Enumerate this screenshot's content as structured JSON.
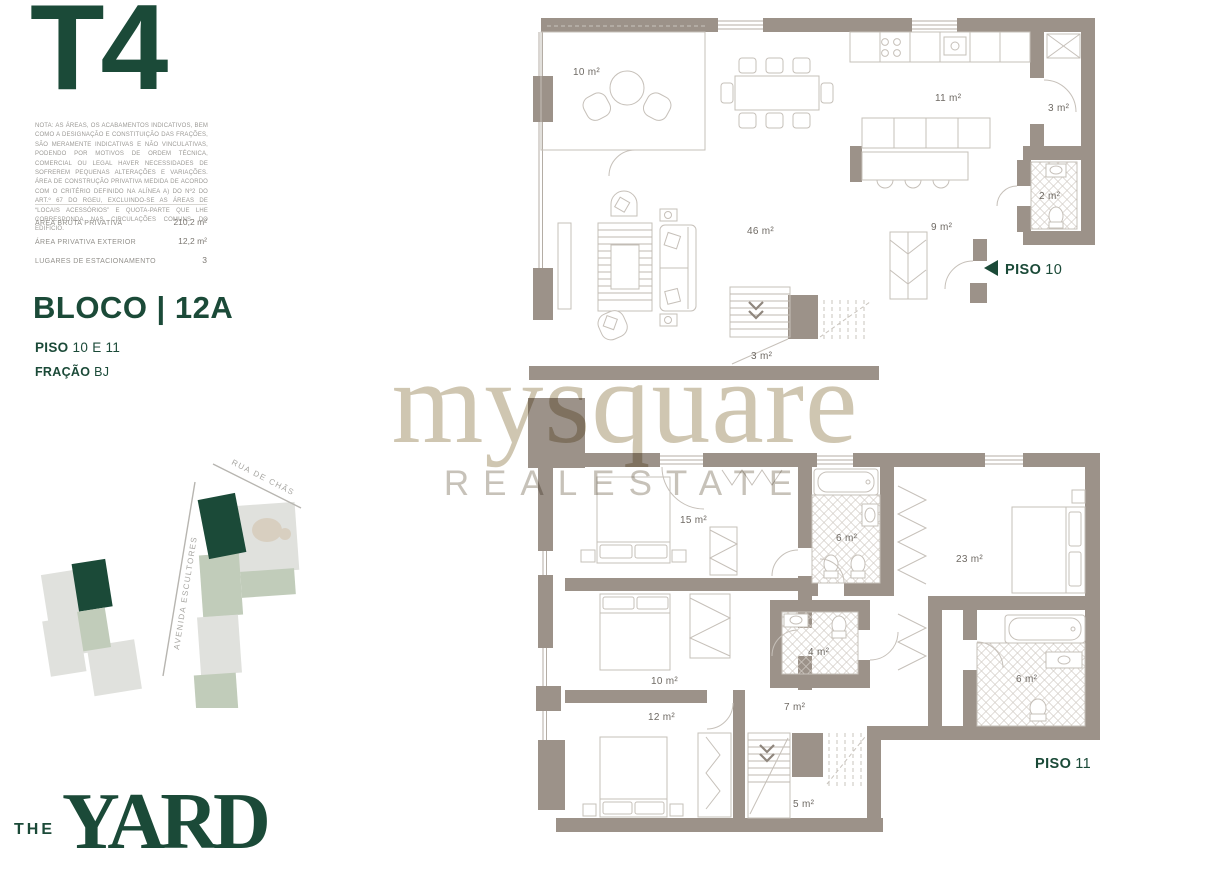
{
  "left_panel": {
    "typology": "T4",
    "disclaimer": "NOTA: AS ÁREAS, OS ACABAMENTOS INDICATIVOS, BEM COMO A DESIGNAÇÃO E CONSTITUIÇÃO DAS FRAÇÕES, SÃO MERAMENTE INDICATIVAS E NÃO VINCULATIVAS, PODENDO POR MOTIVOS DE ORDEM TÉCNICA, COMERCIAL OU LEGAL HAVER NECESSIDADES DE SOFREREM PEQUENAS ALTERAÇÕES E VARIAÇÕES. ÁREA DE CONSTRUÇÃO PRIVATIVA MEDIDA DE ACORDO COM O CRITÉRIO DEFINIDO NA ALÍNEA A) DO Nº2 DO ART.º 67 DO RGEU, EXCLUINDO-SE AS ÁREAS DE “LOCAIS ACESSÓRIOS” E QUOTA-PARTE QUE LHE CORRESPONDA NAS CIRCULAÇÕES COMUNS DO EDIFÍCIO.",
    "areas": [
      {
        "label": "ÁREA BRUTA PRIVATIVA",
        "value": "210,2 m²"
      },
      {
        "label": "ÁREA PRIVATIVA EXTERIOR",
        "value": "12,2 m²"
      },
      {
        "label": "LUGARES DE ESTACIONAMENTO",
        "value": "3"
      }
    ],
    "bloco": "BLOCO | 12A",
    "piso": {
      "label": "PISO",
      "value": "10 E 11"
    },
    "fracao": {
      "label": "FRAÇÃO",
      "value": "BJ"
    },
    "map": {
      "street1": "RUA DE CHÃS",
      "street2": "AVENIDA ESCULTORES"
    }
  },
  "watermark": {
    "name": "mysquare",
    "tagline": "REALESTATE"
  },
  "brand": {
    "the": "THE",
    "yard": "YARD"
  },
  "floorplans": {
    "piso10": {
      "marker_label": "PISO",
      "marker_num": "10",
      "rooms": {
        "terrace": "10 m²",
        "kitchen": "11 m²",
        "storage": "3 m²",
        "wc": "2 m²",
        "hall": "9 m²",
        "living": "46 m²",
        "stairs": "3 m²"
      }
    },
    "piso11": {
      "marker_label": "PISO",
      "marker_num": "11",
      "rooms": {
        "bedroom1": "15 m²",
        "bath1": "6 m²",
        "master": "23 m²",
        "bedroom2": "10 m²",
        "bath2": "4 m²",
        "ensuite": "6 m²",
        "bedroom3": "12 m²",
        "hall": "7 m²",
        "stairs": "5 m²"
      }
    }
  },
  "colors": {
    "brand_green": "#1b4a38",
    "wall_taupe": "#9c9289",
    "watermark_tan": "#c7bda4",
    "map_sage": "#c1ccba",
    "map_gray": "#e0e1dd"
  }
}
